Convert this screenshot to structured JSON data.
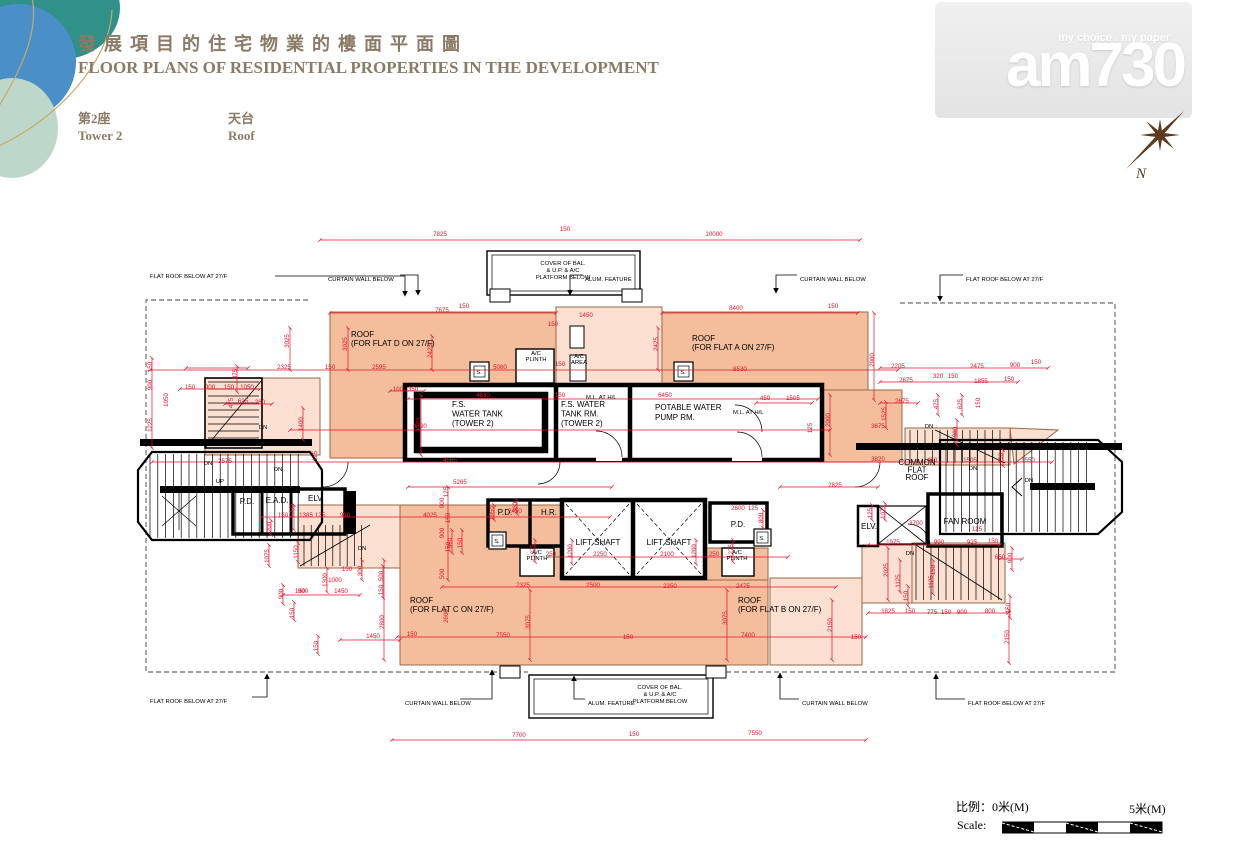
{
  "header": {
    "title_zh": "發展項目的住宅物業的樓面平面圖",
    "title_en": "FLOOR PLANS OF RESIDENTIAL PROPERTIES IN THE DEVELOPMENT",
    "tower_zh": "第2座",
    "tower_en": "Tower 2",
    "floor_zh": "天台",
    "floor_en": "Roof",
    "title_color": "#8a7b66"
  },
  "logo": {
    "tagline": "my choice . my paper",
    "brand": "am730"
  },
  "compass": {
    "label": "N",
    "color": "#5d3a1e"
  },
  "scale_bar": {
    "label_zh": "比例：",
    "zero": "0米(M)",
    "five": "5米(M)",
    "label_en": "Scale:"
  },
  "plan": {
    "colors": {
      "roof_dark": "#f4bd9c",
      "roof_light": "#fbdfd0",
      "dimension_red": "#e8112d",
      "edge_brown": "#9a6845",
      "wall_black": "#000000"
    },
    "rooms": [
      {
        "ls": [
          "ROOF",
          "(FOR FLAT D ON 27/F)"
        ],
        "x": 351,
        "y": 337,
        "s": 7.5,
        "a": "start",
        "lh": 9
      },
      {
        "ls": [
          "ROOF",
          "(FOR FLAT A ON 27/F)"
        ],
        "x": 692,
        "y": 341,
        "s": 7.5,
        "a": "start",
        "lh": 9
      },
      {
        "ls": [
          "ROOF",
          "(FOR FLAT C ON 27/F)"
        ],
        "x": 410,
        "y": 603,
        "s": 7.5,
        "a": "start",
        "lh": 9
      },
      {
        "ls": [
          "ROOF",
          "(FOR FLAT B ON 27/F)"
        ],
        "x": 738,
        "y": 603,
        "s": 7.5,
        "a": "start",
        "lh": 9
      },
      {
        "ls": [
          "F.S.",
          "WATER TANK",
          "(TOWER 2)"
        ],
        "x": 452,
        "y": 407,
        "s": 7.8,
        "a": "start",
        "lh": 9.5
      },
      {
        "ls": [
          "F.S. WATER",
          "TANK RM.",
          "(TOWER 2)"
        ],
        "x": 561,
        "y": 407,
        "s": 7.2,
        "a": "start",
        "lh": 9.5
      },
      {
        "ls": [
          "POTABLE WATER",
          "PUMP RM."
        ],
        "x": 655,
        "y": 410,
        "s": 7.8,
        "a": "start",
        "lh": 10
      },
      {
        "ls": [
          "LIFT SHAFT"
        ],
        "x": 598,
        "y": 545,
        "s": 7.2,
        "a": "middle"
      },
      {
        "ls": [
          "LIFT SHAFT"
        ],
        "x": 669,
        "y": 545,
        "s": 7.2,
        "a": "middle"
      },
      {
        "ls": [
          "FAN ROOM"
        ],
        "x": 965,
        "y": 524,
        "s": 7.2,
        "a": "middle"
      },
      {
        "ls": [
          "COMMON",
          "FLAT",
          "ROOF"
        ],
        "x": 917,
        "y": 465,
        "s": 6.5,
        "a": "middle",
        "lh": 7.5
      },
      {
        "ls": [
          "P.D."
        ],
        "x": 505,
        "y": 515,
        "s": 6.3,
        "a": "middle"
      },
      {
        "ls": [
          "H.R."
        ],
        "x": 549,
        "y": 515,
        "s": 6.3,
        "a": "middle"
      },
      {
        "ls": [
          "P.D."
        ],
        "x": 738,
        "y": 527,
        "s": 6.3,
        "a": "middle"
      },
      {
        "ls": [
          "P.D."
        ],
        "x": 247,
        "y": 504,
        "s": 6.3,
        "a": "middle"
      },
      {
        "ls": [
          "E.A.D."
        ],
        "x": 277,
        "y": 503,
        "s": 6.3,
        "a": "middle"
      },
      {
        "ls": [
          "ELV."
        ],
        "x": 316,
        "y": 501,
        "s": 6.5,
        "a": "middle"
      },
      {
        "ls": [
          "ELV."
        ],
        "x": 869,
        "y": 529,
        "s": 5.8,
        "a": "middle"
      }
    ],
    "annotations": [
      {
        "ls": [
          "FLAT ROOF BELOW AT 27/F"
        ],
        "x": 150,
        "y": 278,
        "a": "start"
      },
      {
        "ls": [
          "CURTAIN WALL BELOW"
        ],
        "x": 328,
        "y": 281,
        "a": "start"
      },
      {
        "ls": [
          "ALUM. FEATURE"
        ],
        "x": 585,
        "y": 281,
        "a": "start"
      },
      {
        "ls": [
          "CURTAIN WALL BELOW"
        ],
        "x": 800,
        "y": 281,
        "a": "start"
      },
      {
        "ls": [
          "FLAT ROOF BELOW AT 27/F"
        ],
        "x": 966,
        "y": 281,
        "a": "start"
      },
      {
        "ls": [
          "COVER OF BAL.",
          "& U.P. & A/C",
          "PLATFORM BELOW"
        ],
        "x": 563,
        "y": 265,
        "a": "middle",
        "lh": 7
      },
      {
        "ls": [
          "COVER OF BAL.",
          "& U.P. & A/C",
          "PLATFORM BELOW"
        ],
        "x": 660,
        "y": 689,
        "a": "middle",
        "lh": 7
      },
      {
        "ls": [
          "CURTAIN WALL BELOW"
        ],
        "x": 405,
        "y": 705,
        "a": "start"
      },
      {
        "ls": [
          "ALUM. FEATURE"
        ],
        "x": 588,
        "y": 705,
        "a": "start"
      },
      {
        "ls": [
          "CURTAIN WALL BELOW"
        ],
        "x": 802,
        "y": 705,
        "a": "start"
      },
      {
        "ls": [
          "FLAT ROOF BELOW AT 27/F"
        ],
        "x": 968,
        "y": 705,
        "a": "start"
      },
      {
        "ls": [
          "FLAT ROOF BELOW AT 27/F"
        ],
        "x": 150,
        "y": 703,
        "a": "start"
      },
      {
        "ls": [
          "A/C",
          "PLINTH"
        ],
        "x": 536,
        "y": 355,
        "a": "middle",
        "lh": 6
      },
      {
        "ls": [
          "A/C",
          "AREA"
        ],
        "x": 579,
        "y": 358,
        "a": "middle",
        "lh": 6
      },
      {
        "ls": [
          "A/C",
          "PLINTH"
        ],
        "x": 537,
        "y": 554,
        "a": "middle",
        "lh": 6
      },
      {
        "ls": [
          "A/C",
          "PLINTH"
        ],
        "x": 737,
        "y": 554,
        "a": "middle",
        "lh": 6
      },
      {
        "ls": [
          "M.L. AT H/L"
        ],
        "x": 586,
        "y": 399,
        "a": "start",
        "s": 5
      },
      {
        "ls": [
          "M.L. AT H/L"
        ],
        "x": 733,
        "y": 414,
        "a": "start",
        "s": 5
      },
      {
        "ls": [
          "S."
        ],
        "x": 479,
        "y": 374,
        "a": "middle",
        "s": 5
      },
      {
        "ls": [
          "S."
        ],
        "x": 683,
        "y": 374,
        "a": "middle",
        "s": 5
      },
      {
        "ls": [
          "S."
        ],
        "x": 497,
        "y": 543,
        "a": "middle",
        "s": 5
      },
      {
        "ls": [
          "S."
        ],
        "x": 762,
        "y": 540,
        "a": "middle",
        "s": 5
      },
      {
        "ls": [
          "DN"
        ],
        "x": 208,
        "y": 465,
        "a": "middle",
        "s": 5
      },
      {
        "ls": [
          "DN"
        ],
        "x": 278,
        "y": 471,
        "a": "middle",
        "s": 5
      },
      {
        "ls": [
          "UP"
        ],
        "x": 220,
        "y": 483,
        "a": "middle",
        "s": 5
      },
      {
        "ls": [
          "DN"
        ],
        "x": 263,
        "y": 429,
        "a": "middle",
        "s": 5
      },
      {
        "ls": [
          "DN"
        ],
        "x": 362,
        "y": 550,
        "a": "middle",
        "s": 5
      },
      {
        "ls": [
          "DN"
        ],
        "x": 910,
        "y": 555,
        "a": "middle",
        "s": 5
      },
      {
        "ls": [
          "DN"
        ],
        "x": 929,
        "y": 428,
        "a": "middle",
        "s": 5
      },
      {
        "ls": [
          "DN"
        ],
        "x": 973,
        "y": 470,
        "a": "middle",
        "s": 5
      },
      {
        "ls": [
          "DN"
        ],
        "x": 1029,
        "y": 482,
        "a": "middle",
        "s": 5
      }
    ],
    "dims": [
      [
        "7825",
        440,
        236
      ],
      [
        "150",
        565,
        231
      ],
      [
        "10000",
        714,
        236
      ],
      [
        "7675",
        442,
        312
      ],
      [
        "150",
        464,
        308
      ],
      [
        "8400",
        736,
        310
      ],
      [
        "150",
        833,
        308
      ],
      [
        "1450",
        586,
        317
      ],
      [
        "150",
        553,
        326
      ],
      [
        "3025",
        289,
        341,
        1
      ],
      [
        "3025",
        347,
        344,
        1
      ],
      [
        "2325",
        284,
        369
      ],
      [
        "150",
        330,
        369
      ],
      [
        "2595",
        379,
        369
      ],
      [
        "2425",
        432,
        351,
        1
      ],
      [
        "5080",
        500,
        369
      ],
      [
        "150",
        560,
        366
      ],
      [
        "2425",
        658,
        344,
        1
      ],
      [
        "8530",
        740,
        371
      ],
      [
        "2900",
        874,
        360,
        1
      ],
      [
        "2205",
        898,
        368
      ],
      [
        "2475",
        977,
        368
      ],
      [
        "900",
        1015,
        367
      ],
      [
        "150",
        1036,
        364
      ],
      [
        "2675",
        906,
        382
      ],
      [
        "320",
        938,
        378
      ],
      [
        "150",
        953,
        378
      ],
      [
        "1855",
        981,
        383
      ],
      [
        "150",
        1009,
        381
      ],
      [
        "2675",
        902,
        403
      ],
      [
        "475",
        938,
        404,
        1
      ],
      [
        "1525",
        886,
        414,
        1
      ],
      [
        "3675",
        878,
        428
      ],
      [
        "625",
        962,
        404,
        1
      ],
      [
        "150",
        980,
        403,
        1
      ],
      [
        "900",
        957,
        432,
        1
      ],
      [
        "150",
        152,
        367,
        1
      ],
      [
        "900",
        152,
        385,
        1
      ],
      [
        "1225",
        152,
        425,
        1
      ],
      [
        "150",
        190,
        389
      ],
      [
        "900",
        210,
        389
      ],
      [
        "150",
        229,
        389
      ],
      [
        "1050",
        247,
        389
      ],
      [
        "875",
        237,
        374,
        1
      ],
      [
        "475",
        233,
        403,
        1
      ],
      [
        "625",
        243,
        403
      ],
      [
        "280",
        260,
        404
      ],
      [
        "1400",
        303,
        424,
        1
      ],
      [
        "4790",
        420,
        428
      ],
      [
        "1050",
        168,
        400,
        1
      ],
      [
        "100",
        398,
        391
      ],
      [
        "350",
        413,
        391
      ],
      [
        "1775",
        421,
        424,
        1
      ],
      [
        "4630",
        483,
        397
      ],
      [
        "150",
        560,
        397
      ],
      [
        "6450",
        665,
        397
      ],
      [
        "450",
        765,
        400
      ],
      [
        "1505",
        793,
        400
      ],
      [
        "2000",
        830,
        420,
        1
      ],
      [
        "125",
        812,
        428,
        1
      ],
      [
        "2575",
        225,
        463
      ],
      [
        "4565",
        450,
        462
      ],
      [
        "125",
        317,
        456,
        1
      ],
      [
        "5265",
        460,
        484
      ],
      [
        "2825",
        835,
        487
      ],
      [
        "3820",
        878,
        461
      ],
      [
        "450",
        932,
        462
      ],
      [
        "1505",
        970,
        462
      ],
      [
        "230",
        1003,
        458,
        1
      ],
      [
        "1550",
        1028,
        462
      ],
      [
        "1385",
        306,
        517
      ],
      [
        "125",
        320,
        517
      ],
      [
        "990",
        345,
        517
      ],
      [
        "4025",
        430,
        517
      ],
      [
        "150",
        283,
        517
      ],
      [
        "1050",
        294,
        511,
        1
      ],
      [
        "200",
        271,
        527,
        1
      ],
      [
        "2450",
        515,
        513
      ],
      [
        "1950",
        494,
        513,
        1
      ],
      [
        "360",
        517,
        507,
        1
      ],
      [
        "2250",
        600,
        556
      ],
      [
        "2100",
        667,
        556
      ],
      [
        "250",
        551,
        556
      ],
      [
        "250",
        714,
        556
      ],
      [
        "1200",
        572,
        551,
        1
      ],
      [
        "1200",
        696,
        551,
        1
      ],
      [
        "1275",
        535,
        551,
        1
      ],
      [
        "1275",
        733,
        551,
        1
      ],
      [
        "2600",
        738,
        510
      ],
      [
        "125",
        753,
        510
      ],
      [
        "800",
        763,
        518,
        1
      ],
      [
        "125",
        448,
        492,
        1
      ],
      [
        "900",
        444,
        503,
        1
      ],
      [
        "150",
        450,
        518,
        1
      ],
      [
        "900",
        444,
        533,
        1
      ],
      [
        "150",
        450,
        547,
        1
      ],
      [
        "500",
        444,
        574,
        1
      ],
      [
        "2325",
        523,
        587
      ],
      [
        "2500",
        593,
        587
      ],
      [
        "2350",
        670,
        588
      ],
      [
        "2475",
        743,
        588
      ],
      [
        "2800",
        384,
        622,
        1
      ],
      [
        "2600",
        448,
        616,
        1
      ],
      [
        "3075",
        530,
        622,
        1
      ],
      [
        "3075",
        727,
        618,
        1
      ],
      [
        "2150",
        832,
        625,
        1
      ],
      [
        "2150",
        1009,
        637,
        1
      ],
      [
        "7550",
        503,
        637
      ],
      [
        "150",
        412,
        636
      ],
      [
        "150",
        628,
        639
      ],
      [
        "7400",
        748,
        637
      ],
      [
        "150",
        856,
        639
      ],
      [
        "7700",
        519,
        737
      ],
      [
        "150",
        634,
        736
      ],
      [
        "7550",
        755,
        735
      ],
      [
        "1075",
        269,
        556,
        1
      ],
      [
        "1150",
        298,
        552,
        1
      ],
      [
        "1300",
        327,
        580,
        1
      ],
      [
        "1000",
        335,
        582
      ],
      [
        "150",
        347,
        571
      ],
      [
        "300",
        362,
        571,
        1
      ],
      [
        "150",
        300,
        593
      ],
      [
        "1450",
        341,
        593
      ],
      [
        "900",
        283,
        594,
        1
      ],
      [
        "900",
        303,
        593
      ],
      [
        "150",
        294,
        613,
        1
      ],
      [
        "500",
        383,
        576,
        1
      ],
      [
        "150",
        383,
        590,
        1
      ],
      [
        "1450",
        373,
        638
      ],
      [
        "150",
        318,
        646,
        1
      ],
      [
        "960",
        452,
        543,
        1
      ],
      [
        "150",
        462,
        543,
        1
      ],
      [
        "1975",
        893,
        544
      ],
      [
        "990",
        939,
        544
      ],
      [
        "925",
        972,
        544
      ],
      [
        "150",
        993,
        543
      ],
      [
        "650",
        1000,
        559
      ],
      [
        "900",
        1012,
        558,
        1
      ],
      [
        "2025",
        888,
        570,
        1
      ],
      [
        "1125",
        900,
        581,
        1
      ],
      [
        "150",
        908,
        596,
        1
      ],
      [
        "1125",
        933,
        582,
        1
      ],
      [
        "150",
        935,
        570,
        1
      ],
      [
        "1825",
        888,
        613
      ],
      [
        "150",
        910,
        613
      ],
      [
        "775",
        932,
        614
      ],
      [
        "150",
        946,
        614
      ],
      [
        "900",
        962,
        614
      ],
      [
        "800",
        990,
        613
      ],
      [
        "150",
        1010,
        608,
        1
      ],
      [
        "3700",
        916,
        525
      ],
      [
        "125",
        977,
        531
      ],
      [
        "125",
        872,
        513,
        1
      ],
      [
        "1075",
        885,
        512,
        1
      ]
    ]
  }
}
